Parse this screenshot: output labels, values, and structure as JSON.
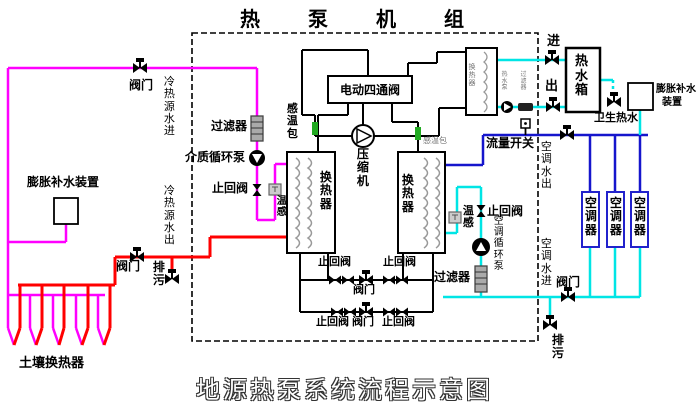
{
  "titles": {
    "top": "热泵机组",
    "bottom": "地源热泵系统流程示意图"
  },
  "ground_loop": {
    "supply_valve": "阀门",
    "supply_pipe": "冷热源水进",
    "expansion_device": "膨胀补水装置",
    "return_pipe": "冷热源水出",
    "return_valve": "阀门",
    "drain": "排污",
    "soil_hx": "土壤换热器"
  },
  "unit": {
    "filter": "过滤器",
    "circulation_pump": "介质循环泵",
    "check_valve": "止回阀",
    "temp_sensor": "温感",
    "sensing_bulb_left": "感温包",
    "hx_left": "换热器",
    "four_way_valve": "电动四通阀",
    "compressor": "压缩机",
    "sensing_bulb_right": "感温包",
    "hx_right": "换热器",
    "plate_hx": "换热器",
    "check_upper_left": "止回阀",
    "valve_upper": "阀门",
    "check_upper_right": "止回阀",
    "check_lower_left": "止回阀",
    "valve_lower": "阀门",
    "check_lower_right": "止回阀"
  },
  "ac_loop": {
    "flow_switch": "流量开关",
    "temp_sensor": "温感",
    "check_valve": "止回阀",
    "water_out": "空调水出",
    "pump": "空调循环泵",
    "filter": "过滤器",
    "water_in": "空调水进",
    "valve": "阀门",
    "drain": "排污",
    "units": [
      {
        "label": "空调器"
      },
      {
        "label": "空调器"
      },
      {
        "label": "空调器"
      }
    ]
  },
  "hot_water": {
    "inlet": "进",
    "outlet": "出",
    "pump": "热水泵",
    "filter": "过滤器",
    "tank": "热水箱",
    "sanitary": "卫生热水",
    "expansion_device_line1": "膨胀补水",
    "expansion_device_line2": "装置"
  },
  "colors": {
    "ground_supply": "#ff00ff",
    "ground_return": "#ff0000",
    "ac_supply": "#1515cc",
    "ac_return": "#00e5e5",
    "refrigerant": "#000000",
    "sensor_bulb": "#22aa22"
  }
}
